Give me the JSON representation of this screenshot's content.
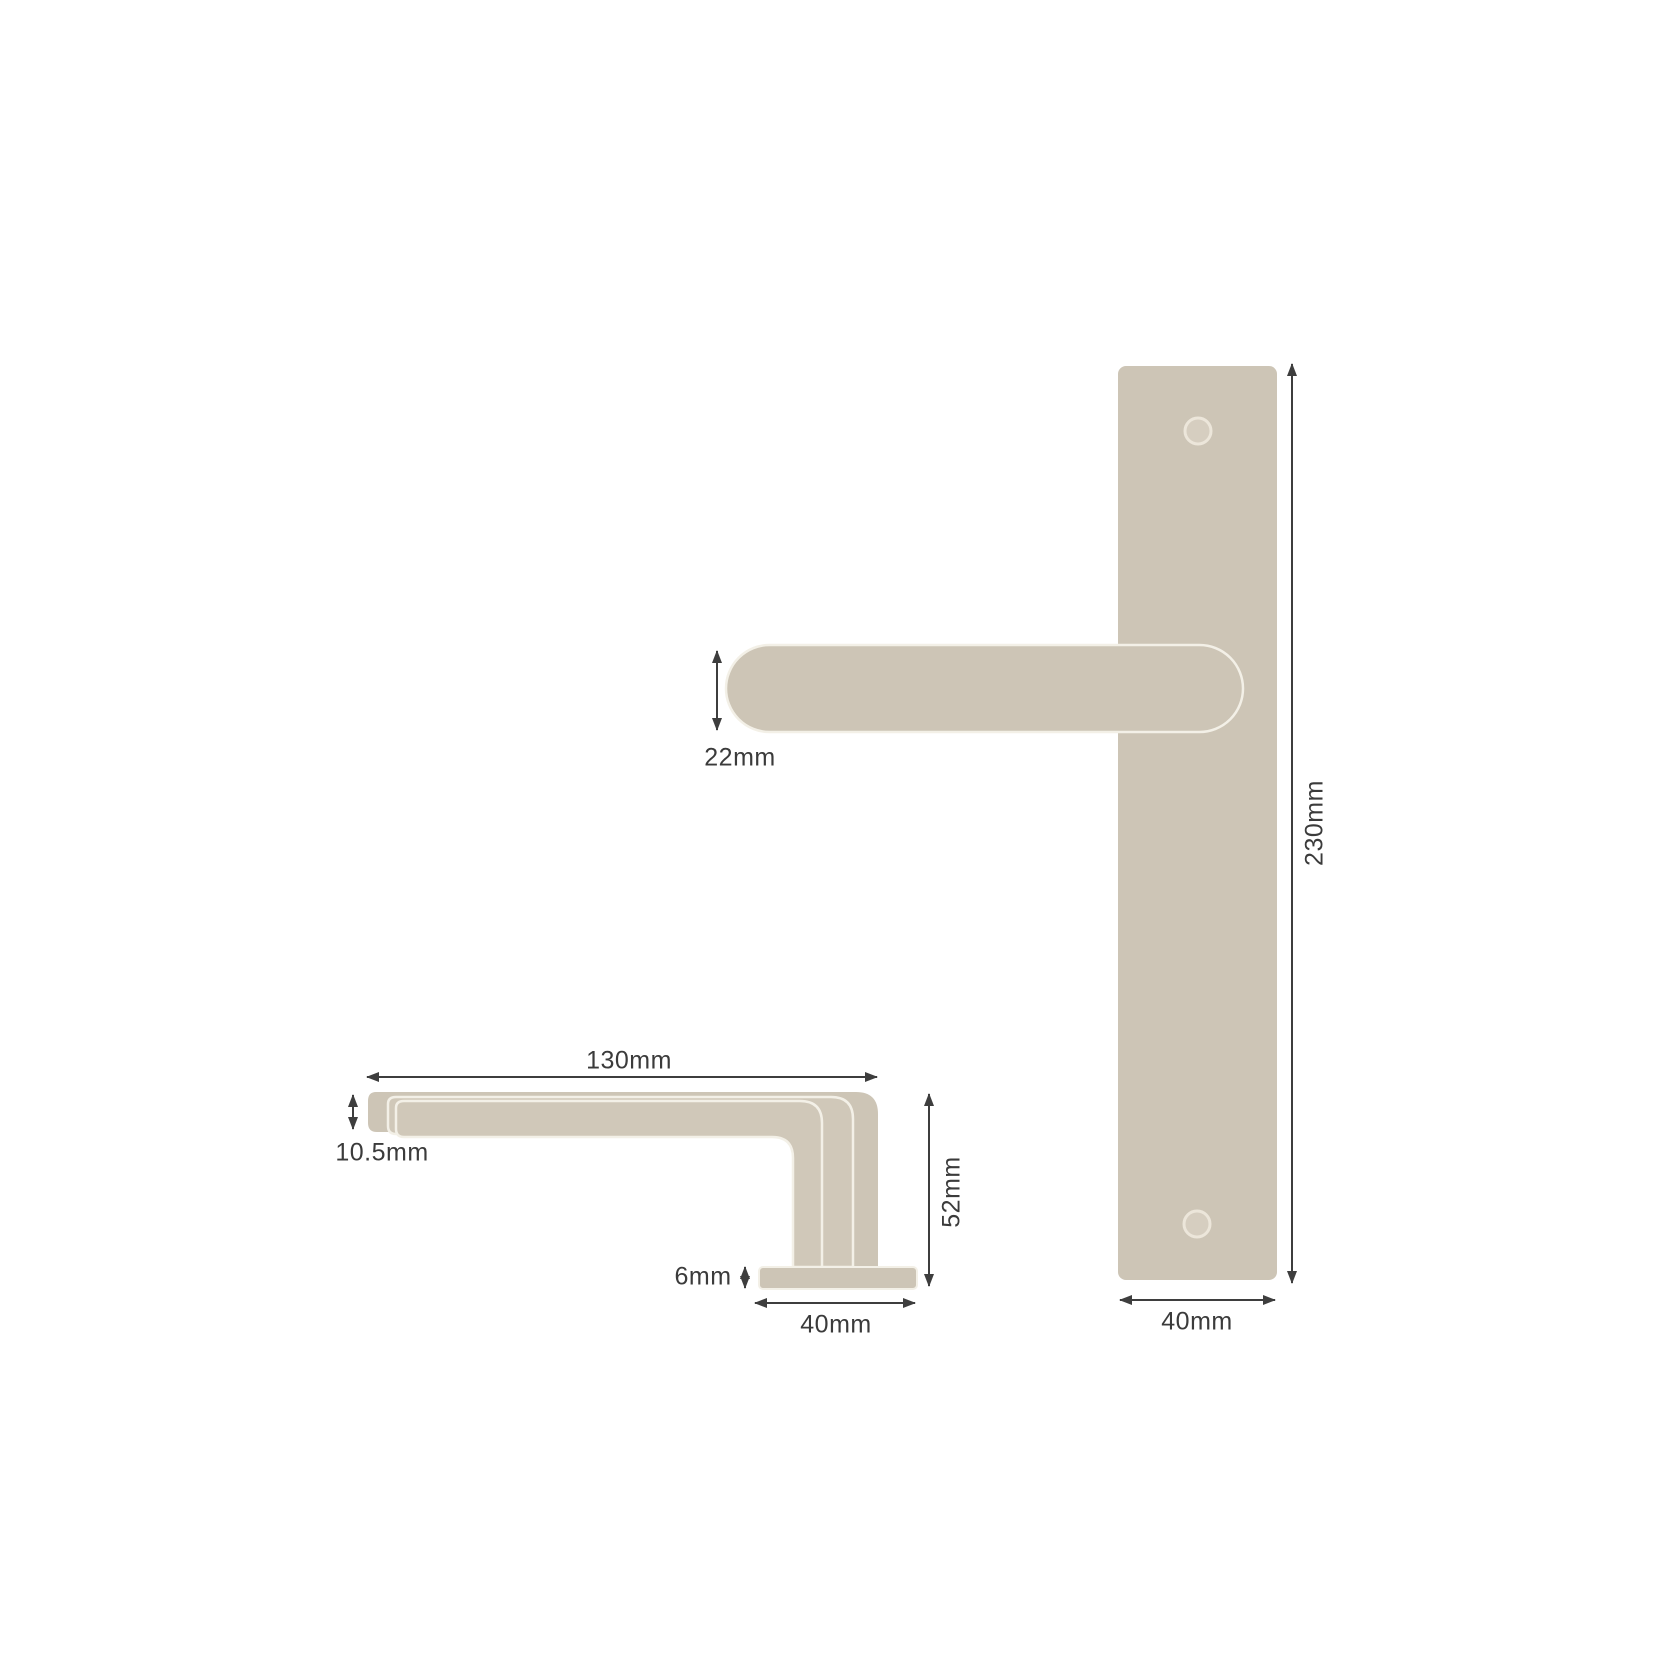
{
  "colors": {
    "background": "#ffffff",
    "metal": "#cdc5b6",
    "metal_inner": "#d0c8b9",
    "hole_fill": "#d6cec0",
    "hole_ring": "#ece6da",
    "edge_highlight": "#f3f0e7",
    "dim_line": "#3e3e3e",
    "text": "#3b3b3b"
  },
  "front_view": {
    "labels": {
      "lever_grip_height": "22mm",
      "plate_height": "230mm",
      "plate_width": "40mm"
    }
  },
  "side_view": {
    "labels": {
      "lever_length": "130mm",
      "lever_thickness": "10.5mm",
      "rose_height": "6mm",
      "projection_height": "52mm",
      "rose_width": "40mm"
    }
  }
}
